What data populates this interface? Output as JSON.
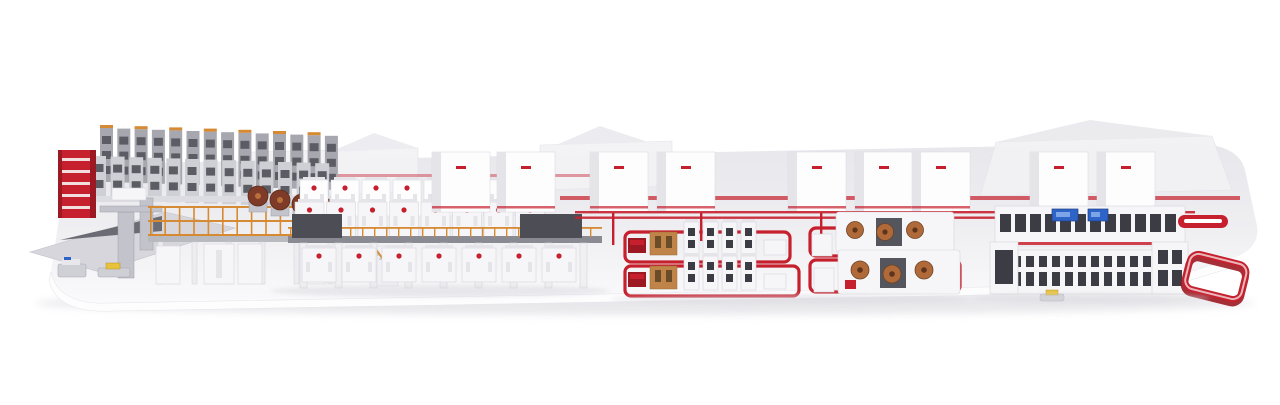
{
  "scene": {
    "description": "3D render of a complete corrugated board production plant on a white pedestal",
    "sections": [
      {
        "name": "roll-storage-racks"
      },
      {
        "name": "red-roll-rack"
      },
      {
        "name": "splicer-infeed-table"
      },
      {
        "name": "agv-shuttles"
      },
      {
        "name": "wet-end-mezzanine"
      },
      {
        "name": "mill-roll-stands"
      },
      {
        "name": "corrugator-double-backer"
      },
      {
        "name": "background-enclosures"
      },
      {
        "name": "dry-end-conveyor"
      },
      {
        "name": "converting-cell-flexo-folder-gluer"
      },
      {
        "name": "converting-cell-rotary-die-cutter"
      },
      {
        "name": "finishing-line"
      },
      {
        "name": "loop-conveyor"
      }
    ],
    "counts": {
      "dryer_modules_back": 8,
      "dryer_modules_front": 8,
      "dryer_modules_lower": 7,
      "support_legs": 9,
      "rack_columns_back": 14,
      "rack_columns_front": 13,
      "mezzanine_posts": 14,
      "railing_posts": 26,
      "finishing_windows_back": 12,
      "finishing_windows_row1": 13,
      "finishing_windows_row2": 13,
      "tower_units_per_row": 4,
      "copper_rolls_per_machine": 3,
      "mill_rolls": 4,
      "enclosure_x": [
        432,
        497,
        590,
        657,
        788,
        855,
        912,
        1030,
        1097
      ]
    }
  },
  "palette": {
    "page_bg": "#ffffff",
    "platform_top": "#ececf0",
    "platform_light": "#f9f9fb",
    "shadow": "#d7d7dd",
    "machine_white": "#f6f6f8",
    "machine_border": "#d6d6dd",
    "machine_shade": "#e4e4e9",
    "panel_dark": "#4d4d55",
    "rack_gray": "#a7a7af",
    "rack_dark": "#5c5c64",
    "rack_light": "#cfcfd6",
    "accent_red": "#c6202e",
    "red_dark": "#9c1822",
    "orange": "#d58a33",
    "wood": "#c08448",
    "roll_brown": "#7e3b28",
    "copper": "#b06a3a",
    "screen_blue": "#2e63c8",
    "steel": "#c3c3cb",
    "yellow": "#e8c23a"
  }
}
